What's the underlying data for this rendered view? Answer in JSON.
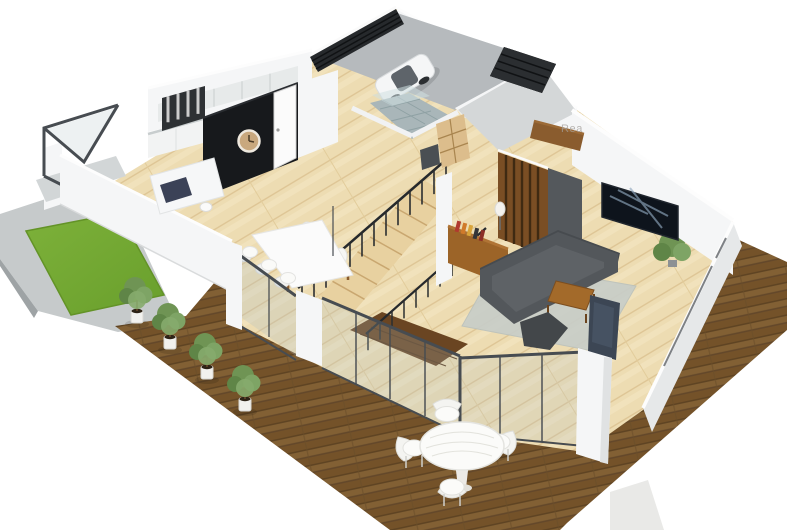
{
  "watermark": {
    "text": "Rea"
  },
  "scene": {
    "counts": {
      "potted_plants": 4,
      "outdoor_chairs": 4,
      "dining_chairs": 6,
      "cars": 1
    }
  },
  "colors": {
    "background": "#ffffff",
    "deck_wood": "#7a5830",
    "deck_seam": "#5f4423",
    "interior_floor": "#eddcb2",
    "floor_seam": "#d9bf8c",
    "grass": "#74a833",
    "grass_dark": "#639327",
    "concrete": "#c6cacb",
    "wall_white": "#f5f6f7",
    "wall_shaded": "#e6e8e9",
    "accent_black": "#17191c",
    "frame_dark": "#474c51",
    "glass_tint": "#aebfc6",
    "sofa_gray": "#53575b",
    "rug_gray": "#c7cdc9",
    "furniture_wood": "#9c6428",
    "slat_wood": "#7a4e24",
    "tile_gray": "#a9b6b9",
    "clock_tan": "#c9a87e",
    "plant_green": "#6f9454",
    "stair_wood": "#e8d1a0",
    "landing_dark": "#6a4522",
    "car_white": "#f5f6f7",
    "garage_floor": "#b6babd",
    "watermark": "#a39f9a"
  }
}
